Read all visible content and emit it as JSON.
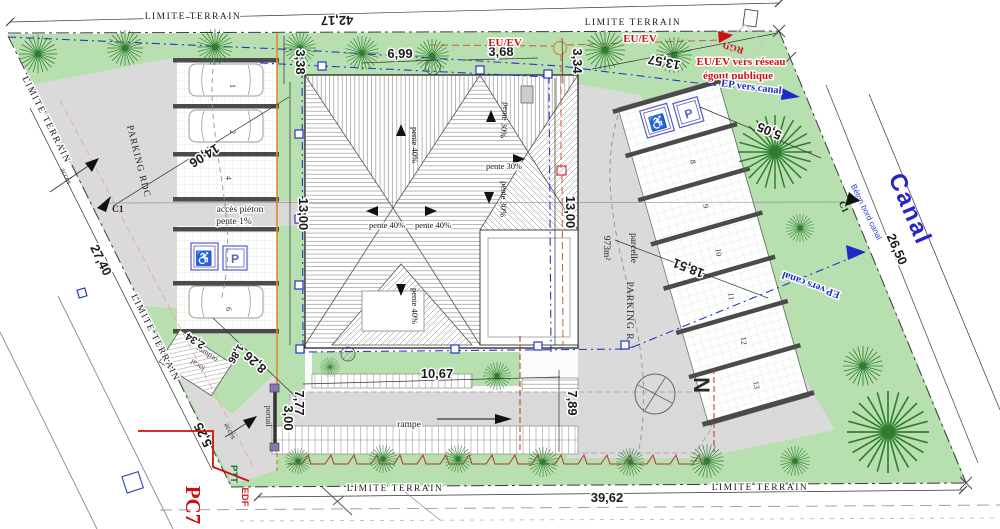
{
  "labels": {
    "limite_terrain": "LIMITE TERRAIN",
    "parking_rdc": "PARKING RDC",
    "parking_r1": "PARKING R-1",
    "parcelle": "parcelle",
    "parcelle_area": "973m²",
    "acces": "accès",
    "acces_pieton": "accès piéton",
    "pente_1": "pente 1%",
    "portail": "portail",
    "rampe": "rampe",
    "local": "local",
    "ordures": "ordures",
    "north": "N",
    "canal": "Canal",
    "beton_bord_canal": "Béton bord canal",
    "pc7": "PC7",
    "ptt": "PTT",
    "edf": "EDF",
    "c1": "C1",
    "rgd": "RGD",
    "eu_ev": "EU/EV",
    "eu_ev_reseau_l1": "EU/EV vers réseau",
    "eu_ev_reseau_l2": "égout publique",
    "ep_vers_canal": "EP vers canal",
    "pente_40": "pente 40%",
    "pente_30": "pente 30%",
    "handicap_p": "P",
    "wheelchair": "♿"
  },
  "dimensions": {
    "top": "42,17",
    "bottom": "39,62",
    "left": "27,40",
    "canal": "26,50",
    "diag_top_right": "13,57",
    "w3_38": "3,38",
    "w6_99": "6,99",
    "w3_68": "3,68",
    "w3_34": "3,34",
    "h13_00": "13,00",
    "d14_06": "14,06",
    "d5_05": "5,05",
    "d18_51": "18,51",
    "d8_26": "8,26",
    "d5_25": "5,25",
    "h7_77": "7,77",
    "h3_00": "3,00",
    "h7_89": "7,89",
    "w10_67": "10,67",
    "d2_34": "2,34",
    "d1_86": "1,86"
  },
  "parking_rdc": {
    "spaces": [
      "1",
      "2",
      "4",
      "6"
    ]
  },
  "parking_r1": {
    "spaces": [
      "8",
      "9",
      "10",
      "11",
      "12",
      "13"
    ]
  }
}
